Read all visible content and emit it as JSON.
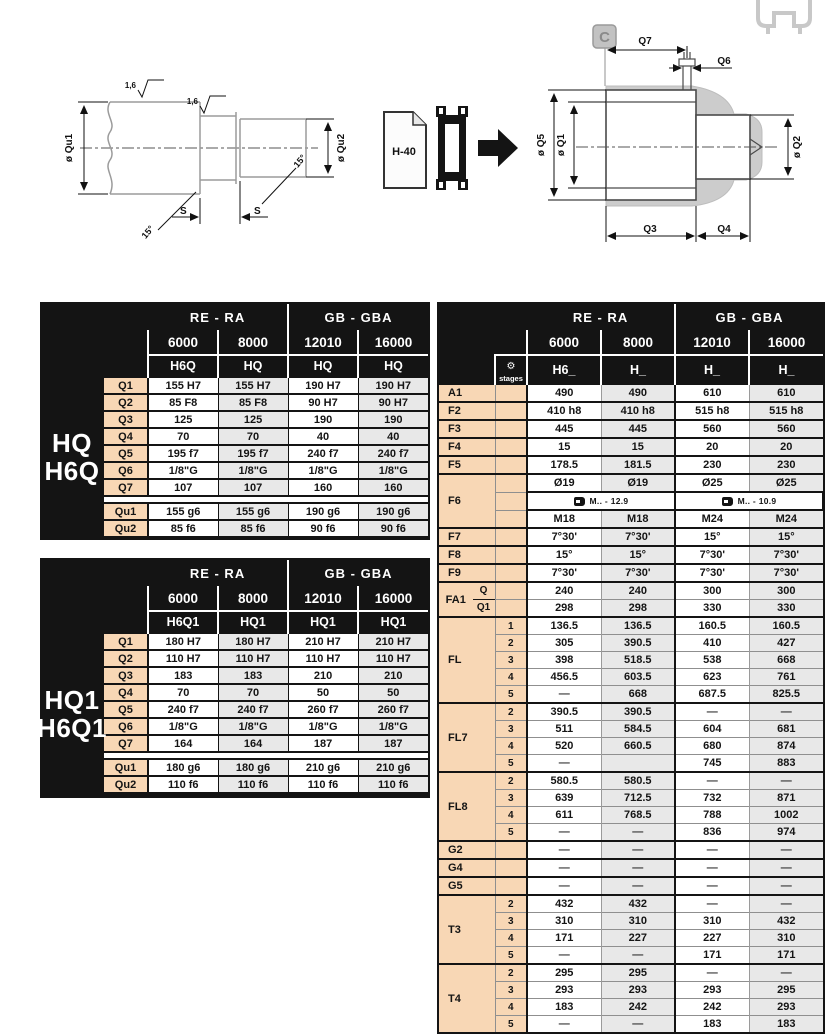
{
  "colors": {
    "header_bg": "#141414",
    "row_label_bg": "#f8d7b5",
    "alt_cell_bg": "#e8e8e8",
    "housing_gray": "#cccccc"
  },
  "drawings": {
    "shaft_view": {
      "qu1_label": "ø Qu1",
      "qu2_label": "ø Qu2",
      "s_label_1": "S",
      "s_label_2": "S",
      "angle_label_1": "15°",
      "angle_label_2": "15°",
      "roughness_1": "1,6",
      "roughness_2": "1,6"
    },
    "reference": {
      "doc_label": "H-40"
    },
    "section_view": {
      "marker": "C",
      "q7": "Q7",
      "q6": "Q6",
      "q5": "ø Q5",
      "q1": "ø Q1",
      "q2": "ø Q2",
      "q3": "Q3",
      "q4": "Q4"
    }
  },
  "tables": {
    "hq": {
      "title_line1": "HQ",
      "title_line2": "H6Q",
      "groups": [
        "RE - RA",
        "GB - GBA"
      ],
      "sizes": [
        "6000",
        "8000",
        "12010",
        "16000"
      ],
      "models": [
        "H6Q",
        "HQ",
        "HQ",
        "HQ"
      ],
      "rows": [
        {
          "label": "Q1",
          "values": [
            "155 H7",
            "155 H7",
            "190 H7",
            "190 H7"
          ]
        },
        {
          "label": "Q2",
          "values": [
            "85 F8",
            "85 F8",
            "90 H7",
            "90 H7"
          ]
        },
        {
          "label": "Q3",
          "values": [
            "125",
            "125",
            "190",
            "190"
          ]
        },
        {
          "label": "Q4",
          "values": [
            "70",
            "70",
            "40",
            "40"
          ]
        },
        {
          "label": "Q5",
          "values": [
            "195 f7",
            "195 f7",
            "240 f7",
            "240 f7"
          ]
        },
        {
          "label": "Q6",
          "values": [
            "1/8\"G",
            "1/8\"G",
            "1/8\"G",
            "1/8\"G"
          ]
        },
        {
          "label": "Q7",
          "values": [
            "107",
            "107",
            "160",
            "160"
          ]
        }
      ],
      "rows_u": [
        {
          "label": "Qu1",
          "values": [
            "155 g6",
            "155 g6",
            "190 g6",
            "190 g6"
          ]
        },
        {
          "label": "Qu2",
          "values": [
            "85 f6",
            "85 f6",
            "90 f6",
            "90 f6"
          ]
        }
      ]
    },
    "hq1": {
      "title_line1": "HQ1",
      "title_line2": "H6Q1",
      "groups": [
        "RE - RA",
        "GB - GBA"
      ],
      "sizes": [
        "6000",
        "8000",
        "12010",
        "16000"
      ],
      "models": [
        "H6Q1",
        "HQ1",
        "HQ1",
        "HQ1"
      ],
      "rows": [
        {
          "label": "Q1",
          "values": [
            "180 H7",
            "180 H7",
            "210 H7",
            "210 H7"
          ]
        },
        {
          "label": "Q2",
          "values": [
            "110 H7",
            "110 H7",
            "110 H7",
            "110 H7"
          ]
        },
        {
          "label": "Q3",
          "values": [
            "183",
            "183",
            "210",
            "210"
          ]
        },
        {
          "label": "Q4",
          "values": [
            "70",
            "70",
            "50",
            "50"
          ]
        },
        {
          "label": "Q5",
          "values": [
            "240 f7",
            "240 f7",
            "260 f7",
            "260 f7"
          ]
        },
        {
          "label": "Q6",
          "values": [
            "1/8\"G",
            "1/8\"G",
            "1/8\"G",
            "1/8\"G"
          ]
        },
        {
          "label": "Q7",
          "values": [
            "164",
            "164",
            "187",
            "187"
          ]
        }
      ],
      "rows_u": [
        {
          "label": "Qu1",
          "values": [
            "180 g6",
            "180 g6",
            "210 g6",
            "210 g6"
          ]
        },
        {
          "label": "Qu2",
          "values": [
            "110 f6",
            "110 f6",
            "110 f6",
            "110 f6"
          ]
        }
      ]
    },
    "dims": {
      "groups": [
        "RE - RA",
        "GB - GBA"
      ],
      "sizes": [
        "6000",
        "8000",
        "12010",
        "16000"
      ],
      "models": [
        "H6_",
        "H_",
        "H_",
        "H_"
      ],
      "stages_label": "stages",
      "bolt_row": {
        "left": "M.. - 12.9",
        "right": "M.. - 10.9"
      },
      "row_groups": [
        {
          "label": "A1",
          "rows": [
            {
              "stage": "",
              "values": [
                "490",
                "490",
                "610",
                "610"
              ]
            }
          ]
        },
        {
          "label": "F2",
          "rows": [
            {
              "stage": "",
              "values": [
                "410 h8",
                "410 h8",
                "515 h8",
                "515 h8"
              ]
            }
          ]
        },
        {
          "label": "F3",
          "rows": [
            {
              "stage": "",
              "values": [
                "445",
                "445",
                "560",
                "560"
              ]
            }
          ]
        },
        {
          "label": "F4",
          "rows": [
            {
              "stage": "",
              "values": [
                "15",
                "15",
                "20",
                "20"
              ]
            }
          ]
        },
        {
          "label": "F5",
          "rows": [
            {
              "stage": "",
              "values": [
                "178.5",
                "181.5",
                "230",
                "230"
              ]
            }
          ]
        },
        {
          "label": "F6",
          "rows": [
            {
              "stage": "",
              "values": [
                "Ø19",
                "Ø19",
                "Ø25",
                "Ø25"
              ]
            },
            {
              "bolt": true
            },
            {
              "stage": "",
              "values": [
                "M18",
                "M18",
                "M24",
                "M24"
              ]
            }
          ]
        },
        {
          "label": "F7",
          "rows": [
            {
              "stage": "",
              "values": [
                "7°30'",
                "7°30'",
                "15°",
                "15°"
              ]
            }
          ]
        },
        {
          "label": "F8",
          "rows": [
            {
              "stage": "",
              "values": [
                "15°",
                "15°",
                "7°30'",
                "7°30'"
              ]
            }
          ]
        },
        {
          "label": "F9",
          "rows": [
            {
              "stage": "",
              "values": [
                "7°30'",
                "7°30'",
                "7°30'",
                "7°30'"
              ]
            }
          ]
        },
        {
          "label": "FA1",
          "rows": [
            {
              "sub": "Q",
              "stage": "",
              "values": [
                "240",
                "240",
                "300",
                "300"
              ]
            },
            {
              "sub": "Q1",
              "stage": "",
              "values": [
                "298",
                "298",
                "330",
                "330"
              ]
            }
          ]
        },
        {
          "label": "FL",
          "rows": [
            {
              "stage": "1",
              "values": [
                "136.5",
                "136.5",
                "160.5",
                "160.5"
              ]
            },
            {
              "stage": "2",
              "values": [
                "305",
                "390.5",
                "410",
                "427"
              ]
            },
            {
              "stage": "3",
              "values": [
                "398",
                "518.5",
                "538",
                "668"
              ]
            },
            {
              "stage": "4",
              "values": [
                "456.5",
                "603.5",
                "623",
                "761"
              ]
            },
            {
              "stage": "5",
              "values": [
                "—",
                "668",
                "687.5",
                "825.5"
              ]
            }
          ]
        },
        {
          "label": "FL7",
          "rows": [
            {
              "stage": "2",
              "values": [
                "390.5",
                "390.5",
                "—",
                "—"
              ]
            },
            {
              "stage": "3",
              "values": [
                "511",
                "584.5",
                "604",
                "681"
              ]
            },
            {
              "stage": "4",
              "values": [
                "520",
                "660.5",
                "680",
                "874"
              ]
            },
            {
              "stage": "5",
              "values": [
                "—",
                "",
                "745",
                "883"
              ]
            }
          ]
        },
        {
          "label": "FL8",
          "rows": [
            {
              "stage": "2",
              "values": [
                "580.5",
                "580.5",
                "—",
                "—"
              ]
            },
            {
              "stage": "3",
              "values": [
                "639",
                "712.5",
                "732",
                "871"
              ]
            },
            {
              "stage": "4",
              "values": [
                "611",
                "768.5",
                "788",
                "1002"
              ]
            },
            {
              "stage": "5",
              "values": [
                "—",
                "—",
                "836",
                "974"
              ]
            }
          ]
        },
        {
          "label": "G2",
          "rows": [
            {
              "stage": "",
              "values": [
                "—",
                "—",
                "—",
                "—"
              ]
            }
          ]
        },
        {
          "label": "G4",
          "rows": [
            {
              "stage": "",
              "values": [
                "—",
                "—",
                "—",
                "—"
              ]
            }
          ]
        },
        {
          "label": "G5",
          "rows": [
            {
              "stage": "",
              "values": [
                "—",
                "—",
                "—",
                "—"
              ]
            }
          ]
        },
        {
          "label": "T3",
          "rows": [
            {
              "stage": "2",
              "values": [
                "432",
                "432",
                "—",
                "—"
              ]
            },
            {
              "stage": "3",
              "values": [
                "310",
                "310",
                "310",
                "432"
              ]
            },
            {
              "stage": "4",
              "values": [
                "171",
                "227",
                "227",
                "310"
              ]
            },
            {
              "stage": "5",
              "values": [
                "—",
                "—",
                "171",
                "171"
              ]
            }
          ]
        },
        {
          "label": "T4",
          "rows": [
            {
              "stage": "2",
              "values": [
                "295",
                "295",
                "—",
                "—"
              ]
            },
            {
              "stage": "3",
              "values": [
                "293",
                "293",
                "293",
                "295"
              ]
            },
            {
              "stage": "4",
              "values": [
                "183",
                "242",
                "242",
                "293"
              ]
            },
            {
              "stage": "5",
              "values": [
                "—",
                "—",
                "183",
                "183"
              ]
            }
          ]
        }
      ]
    }
  }
}
